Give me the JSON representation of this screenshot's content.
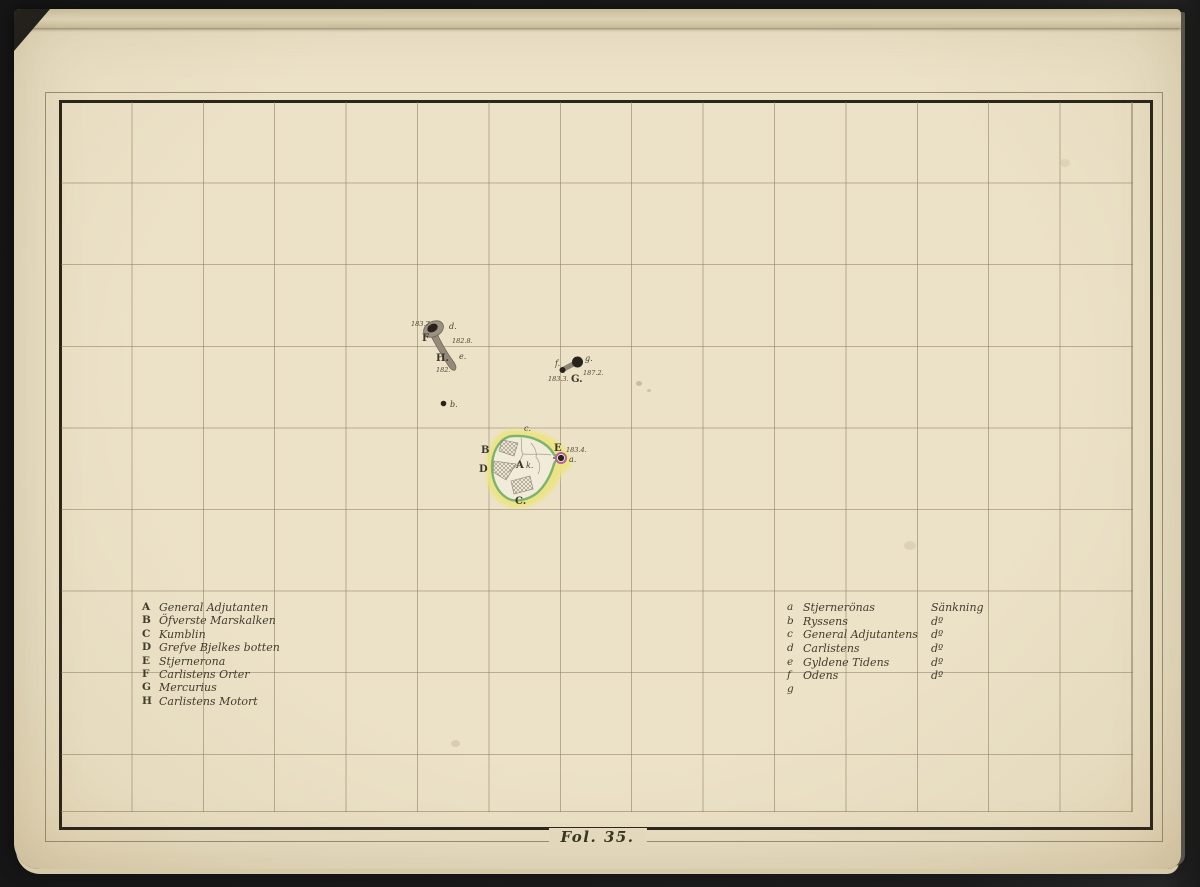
{
  "page": {
    "folio_caption": "Fol. 35."
  },
  "legend_left": {
    "items": [
      {
        "key": "A",
        "name": "General Adjutanten"
      },
      {
        "key": "B",
        "name": "Öfverste Marskalken"
      },
      {
        "key": "C",
        "name": "Kumblin"
      },
      {
        "key": "D",
        "name": "Grefve Bjelkes botten"
      },
      {
        "key": "E",
        "name": "Stjernerona"
      },
      {
        "key": "F",
        "name": "Carlistens Orter"
      },
      {
        "key": "G",
        "name": "Mercurius"
      },
      {
        "key": "H",
        "name": "Carlistens Motort"
      }
    ]
  },
  "legend_right": {
    "items": [
      {
        "key": "a",
        "name": "Stjernerönas",
        "ditto": "Sänkning"
      },
      {
        "key": "b",
        "name": "Ryssens",
        "ditto": "dº"
      },
      {
        "key": "c",
        "name": "General Adjutantens",
        "ditto": "dº"
      },
      {
        "key": "d",
        "name": "Carlistens",
        "ditto": "dº"
      },
      {
        "key": "e",
        "name": "Gyldene Tidens",
        "ditto": "dº"
      },
      {
        "key": "f",
        "name": "Odens",
        "ditto": "dº"
      },
      {
        "key": "g",
        "name": "",
        "ditto": ""
      }
    ]
  },
  "map": {
    "feature_h": {
      "elev_top": "183.7.",
      "d": "d.",
      "f_label": "F",
      "elev_mid": "182.8.",
      "h_label": "H.",
      "e": "e.",
      "elev_bottom": "182."
    },
    "feature_g": {
      "f": "f.",
      "g": "g.",
      "elev_left": "183.3.",
      "g_label": "G.",
      "elev_right": "187.2."
    },
    "feature_b": {
      "b": "b."
    },
    "pond": {
      "c": "c.",
      "b_label": "B",
      "e_label": "E",
      "elev": "183.4.",
      "a": "a.",
      "d_label": "D",
      "a_label": "A",
      "k": "k.",
      "c_label": "C."
    }
  },
  "colors": {
    "paper": "#e9dfc4",
    "surround": "#1d1d1d",
    "border_ink": "#2b261a",
    "grid_line": "#8b7c5e",
    "text_ink": "#45402f",
    "pond_halo_yellow": "#ece482",
    "pond_ring_green": "#7db36f",
    "marker_ring_pink": "#b5639b",
    "marker_dot": "#27221a",
    "shaft_gray": "#938a79"
  }
}
